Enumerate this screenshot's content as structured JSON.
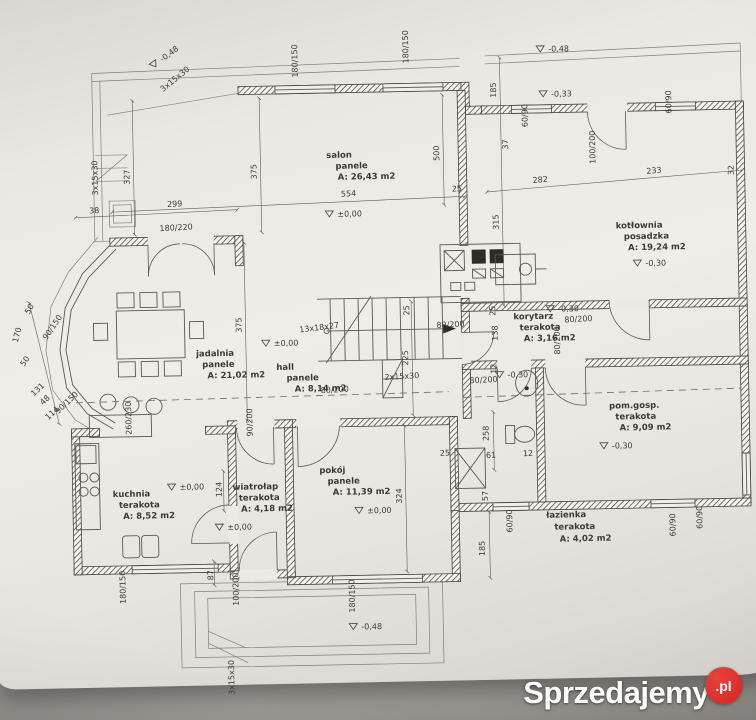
{
  "watermark": {
    "brand": "Sprzedajemy",
    "tld": ".pl",
    "accent_color": "#d2261f"
  },
  "plan": {
    "rooms": [
      {
        "id": "salon",
        "name": "salon",
        "floor": "panele",
        "area": "A: 26,43 m2"
      },
      {
        "id": "kotlownia",
        "name": "kotłownia",
        "floor": "posadzka",
        "area": "A: 19,24 m2"
      },
      {
        "id": "korytarz",
        "name": "korytarz",
        "floor": "terakota",
        "area": "A: 3,16 m2"
      },
      {
        "id": "jadalnia",
        "name": "jadalnia",
        "floor": "panele",
        "area": "A: 21,02 m2"
      },
      {
        "id": "hall",
        "name": "hall",
        "floor": "panele",
        "area": "A: 8,14 m2"
      },
      {
        "id": "pomgosp",
        "name": "pom.gosp.",
        "floor": "terakota",
        "area": "A: 9,09 m2"
      },
      {
        "id": "kuchnia",
        "name": "kuchnia",
        "floor": "terakota",
        "area": "A: 8,52 m2"
      },
      {
        "id": "wiatrolap",
        "name": "wiatrołap",
        "floor": "terakota",
        "area": "A: 4,18 m2"
      },
      {
        "id": "pokoj",
        "name": "pokój",
        "floor": "panele",
        "area": "A: 11,39 m2"
      },
      {
        "id": "lazienka",
        "name": "łazienka",
        "floor": "terakota",
        "area": "A: 4,02 m2"
      }
    ],
    "levels": [
      {
        "t": "±0,00",
        "x": 340,
        "y": 216
      },
      {
        "t": "±0,00",
        "x": 274,
        "y": 344
      },
      {
        "t": "±0,00",
        "x": 177,
        "y": 486
      },
      {
        "t": "±0,00",
        "x": 224,
        "y": 527
      },
      {
        "t": "±0,00",
        "x": 364,
        "y": 513
      },
      {
        "t": "-0,30",
        "x": 647,
        "y": 271
      },
      {
        "t": "-0,30",
        "x": 559,
        "y": 315
      },
      {
        "t": "-0,30",
        "x": 507,
        "y": 380
      },
      {
        "t": "-0,30",
        "x": 610,
        "y": 453
      },
      {
        "t": "-0,33",
        "x": 556,
        "y": 100
      },
      {
        "t": "-0,48",
        "x": 168,
        "y": 58,
        "r": -35
      },
      {
        "t": "-0,48",
        "x": 554,
        "y": 55
      },
      {
        "t": "-0,48",
        "x": 356,
        "y": 629
      }
    ],
    "stairs": [
      {
        "t": "13x18x27",
        "x": 300,
        "y": 331,
        "r": -6
      },
      {
        "t": "2x15x30",
        "x": 384,
        "y": 380,
        "r": -2
      },
      {
        "t": "3x15x30",
        "x": 101,
        "y": 190,
        "r": -90
      },
      {
        "t": "3x15x30",
        "x": 168,
        "y": 88,
        "r": -38
      },
      {
        "t": "3x15x30",
        "x": 228,
        "y": 692,
        "r": -90
      }
    ],
    "dimensions": [
      {
        "t": "38",
        "x": 92,
        "y": 208,
        "r": -2
      },
      {
        "t": "299",
        "x": 170,
        "y": 203,
        "r": -2
      },
      {
        "t": "554",
        "x": 344,
        "y": 196,
        "r": -2
      },
      {
        "t": "25",
        "x": 455,
        "y": 193,
        "r": -2
      },
      {
        "t": "500",
        "x": 443,
        "y": 162,
        "r": -90
      },
      {
        "t": "282",
        "x": 536,
        "y": 186,
        "r": -4
      },
      {
        "t": "233",
        "x": 650,
        "y": 179,
        "r": -4
      },
      {
        "t": "32",
        "x": 737,
        "y": 182,
        "r": -90
      },
      {
        "t": "185",
        "x": 501,
        "y": 100,
        "r": -90
      },
      {
        "t": "37",
        "x": 512,
        "y": 152,
        "r": -90
      },
      {
        "t": "315",
        "x": 501,
        "y": 232,
        "r": -90
      },
      {
        "t": "327",
        "x": 133,
        "y": 180,
        "r": -90
      },
      {
        "t": "375",
        "x": 260,
        "y": 177,
        "r": -90
      },
      {
        "t": "375",
        "x": 242,
        "y": 330,
        "r": -90
      },
      {
        "t": "180/220",
        "x": 162,
        "y": 227,
        "r": -2
      },
      {
        "t": "180/150",
        "x": 303,
        "y": 76,
        "r": -90
      },
      {
        "t": "180/150",
        "x": 414,
        "y": 64,
        "r": -90
      },
      {
        "t": "60/90",
        "x": 532,
        "y": 130,
        "r": -90
      },
      {
        "t": "60/90",
        "x": 676,
        "y": 119,
        "r": -90
      },
      {
        "t": "100/200",
        "x": 599,
        "y": 168,
        "r": -90
      },
      {
        "t": "50",
        "x": 30,
        "y": 308,
        "r": -60
      },
      {
        "t": "170",
        "x": 18,
        "y": 336,
        "r": -75
      },
      {
        "t": "90/150",
        "x": 47,
        "y": 334,
        "r": -55
      },
      {
        "t": "50",
        "x": 24,
        "y": 360,
        "r": -55
      },
      {
        "t": "131",
        "x": 33,
        "y": 390,
        "r": -42
      },
      {
        "t": "48",
        "x": 42,
        "y": 399,
        "r": -42
      },
      {
        "t": "90/150",
        "x": 57,
        "y": 408,
        "r": -42
      },
      {
        "t": "114",
        "x": 47,
        "y": 414,
        "r": -42
      },
      {
        "t": "260/230",
        "x": 130,
        "y": 430,
        "r": -90
      },
      {
        "t": "124",
        "x": 219,
        "y": 494,
        "r": -90
      },
      {
        "t": "25",
        "x": 410,
        "y": 316,
        "r": -90
      },
      {
        "t": "225",
        "x": 408,
        "y": 366,
        "r": -90
      },
      {
        "t": "80/200",
        "x": 437,
        "y": 329,
        "r": -2
      },
      {
        "t": "80/200",
        "x": 565,
        "y": 326,
        "r": -2
      },
      {
        "t": "80/200",
        "x": 560,
        "y": 358,
        "r": -90
      },
      {
        "t": "80/200",
        "x": 469,
        "y": 385,
        "r": -2
      },
      {
        "t": "80/200",
        "x": 320,
        "y": 392,
        "r": -2
      },
      {
        "t": "90/200",
        "x": 251,
        "y": 434,
        "r": -90
      },
      {
        "t": "25",
        "x": 496,
        "y": 318,
        "r": -90
      },
      {
        "t": "138",
        "x": 498,
        "y": 343,
        "r": -90
      },
      {
        "t": "12",
        "x": 496,
        "y": 376,
        "r": -90
      },
      {
        "t": "324",
        "x": 399,
        "y": 504,
        "r": -90
      },
      {
        "t": "258",
        "x": 487,
        "y": 443,
        "r": -90
      },
      {
        "t": "61",
        "x": 484,
        "y": 460,
        "r": -2
      },
      {
        "t": "12",
        "x": 521,
        "y": 459,
        "r": -2
      },
      {
        "t": "25",
        "x": 438,
        "y": 457,
        "r": -2
      },
      {
        "t": "57",
        "x": 485,
        "y": 503,
        "r": -90
      },
      {
        "t": "185",
        "x": 481,
        "y": 558,
        "r": -90
      },
      {
        "t": "87",
        "x": 209,
        "y": 577,
        "r": -90
      },
      {
        "t": "180/150",
        "x": 121,
        "y": 599,
        "r": -90
      },
      {
        "t": "100/200",
        "x": 234,
        "y": 603,
        "r": -90
      },
      {
        "t": "180/150",
        "x": 350,
        "y": 612,
        "r": -90
      },
      {
        "t": "60/90",
        "x": 509,
        "y": 535,
        "r": -90
      },
      {
        "t": "60/90",
        "x": 672,
        "y": 542,
        "r": -90
      },
      {
        "t": "60/90",
        "x": 699,
        "y": 535,
        "r": -90
      }
    ]
  }
}
